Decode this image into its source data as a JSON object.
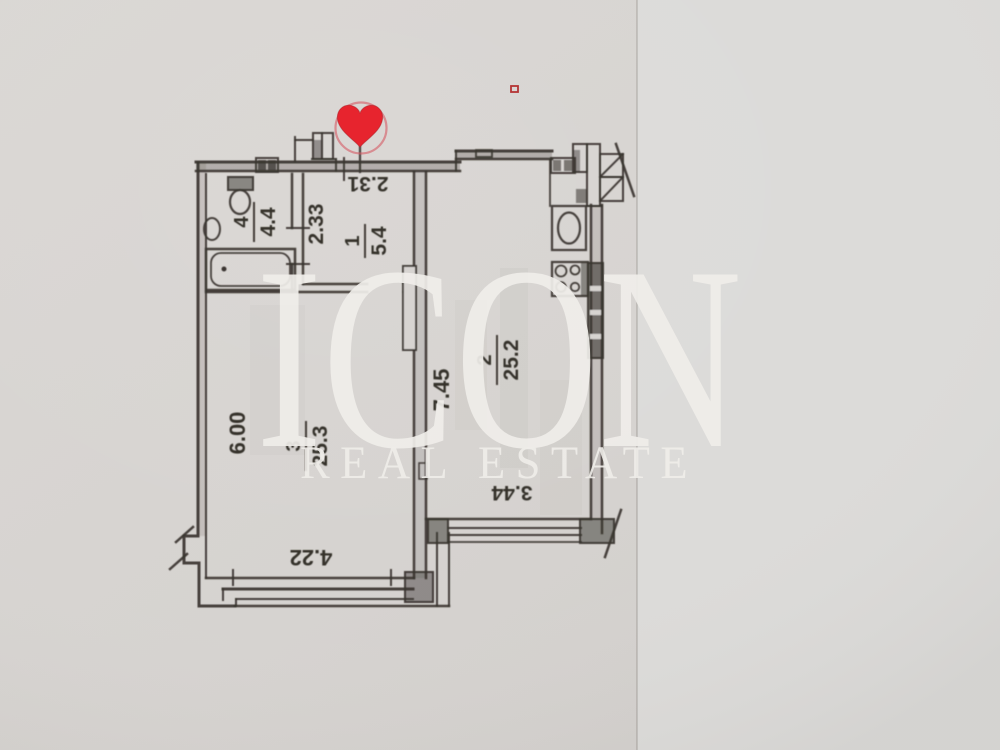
{
  "watermark": {
    "brand": "ICON",
    "tagline": "REAL ESTATE"
  },
  "marker": {
    "shape": "heart",
    "color": "#e7242e"
  },
  "colors": {
    "paper": "#d7d4d1",
    "ink": "#3a3530",
    "watermark": "#f0eeea",
    "heart": "#e7242e"
  },
  "rooms": [
    {
      "number": "1",
      "area": "5.4"
    },
    {
      "number": "2",
      "area": "25.2"
    },
    {
      "number": "3",
      "area": "25.3"
    },
    {
      "number": "4",
      "area": "4.4"
    }
  ],
  "dimensions": {
    "hall_width": "2.31",
    "hall_depth": "2.33",
    "living_length": "7.45",
    "living_width": "3.44",
    "bedroom_length": "6.00",
    "bedroom_width": "4.22"
  }
}
